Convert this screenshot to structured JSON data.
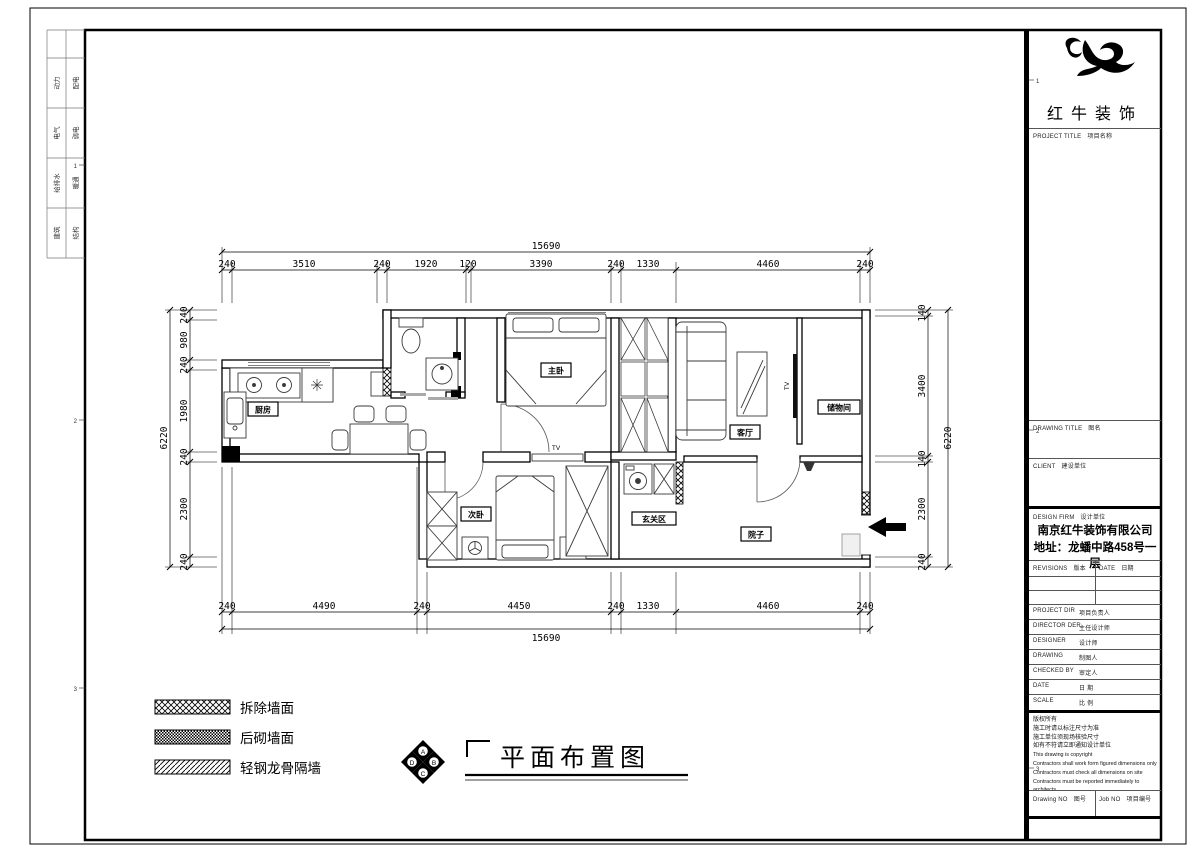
{
  "colors": {
    "ink": "#000000",
    "paper": "#ffffff"
  },
  "border": {
    "disciplines": [
      {
        "a": "动力",
        "b": "配电"
      },
      {
        "a": "电气",
        "b": "弱电"
      },
      {
        "a": "给排水",
        "b": "暖通"
      },
      {
        "a": "建筑",
        "b": "结构"
      }
    ],
    "grid_refs": [
      "1",
      "2",
      "3"
    ]
  },
  "title_block": {
    "brand": "红牛装饰",
    "project_title": {
      "en": "PROJECT TITLE",
      "cn": "项目名称"
    },
    "drawing_title": {
      "en": "DRAWING TITLE",
      "cn": "图名"
    },
    "client": {
      "en": "CLIENT",
      "cn": "建设单位"
    },
    "design_firm": {
      "en": "DESIGN FIRM",
      "cn": "设计单位"
    },
    "company": "南京红牛装饰有限公司",
    "address": "地址：龙蟠中路458号一层",
    "revisions": {
      "en": "REVISIONS",
      "cn": "版本"
    },
    "date_col": {
      "en": "DATE",
      "cn": "日期"
    },
    "rows": [
      {
        "en": "PROJECT DIR",
        "cn": "项目负责人"
      },
      {
        "en": "DIRECTOR DER",
        "cn": "主任设计师"
      },
      {
        "en": "DESIGNER",
        "cn": "设计师"
      },
      {
        "en": "DRAWING",
        "cn": "制图人"
      },
      {
        "en": "CHECKED BY",
        "cn": "审定人"
      },
      {
        "en": "DATE",
        "cn": "日 期"
      },
      {
        "en": "SCALE",
        "cn": "比 例"
      }
    ],
    "copyright": [
      "版权所有",
      "施工时请以标注尺寸为准",
      "施工单位须现场核验尺寸",
      "如有不符请立即通知设计单位",
      "This drawing is copyright",
      "Contractors shall work form figured dimensions only",
      "Contractors must check all dimensions on site",
      "Contractors must be reported immediately to architects"
    ],
    "drawing_no": {
      "en": "Drawing NO",
      "cn": "图号"
    },
    "job_no": {
      "en": "Job NO",
      "cn": "项目编号"
    }
  },
  "plan": {
    "rooms": [
      {
        "name": "厨房"
      },
      {
        "name": "主卧"
      },
      {
        "name": "客厅"
      },
      {
        "name": "储物间"
      },
      {
        "name": "次卧"
      },
      {
        "name": "玄关区"
      },
      {
        "name": "院子"
      }
    ],
    "tv_labels": [
      "TV",
      "TV"
    ],
    "dimensions": {
      "top": {
        "overall": "15690",
        "segments": [
          "240",
          "3510",
          "240",
          "1920",
          "120",
          "3390",
          "240",
          "1330",
          "4460",
          "240"
        ]
      },
      "bottom": {
        "overall": "15690",
        "segments": [
          "240",
          "4490",
          "240",
          "4450",
          "240",
          "1330",
          "4460",
          "240"
        ]
      },
      "left": {
        "overall": "6220",
        "segments": [
          "240",
          "980",
          "240",
          "1980",
          "240",
          "2300",
          "240"
        ]
      },
      "right": {
        "overall": "6220",
        "segments": [
          "140",
          "3400",
          "140",
          "2300",
          "240"
        ]
      }
    }
  },
  "legend": {
    "items": [
      {
        "label": "拆除墙面"
      },
      {
        "label": "后砌墙面"
      },
      {
        "label": "轻钢龙骨隔墙"
      }
    ]
  },
  "sheet_title": {
    "text": "平面布置图",
    "compass": [
      "A",
      "B",
      "C",
      "D"
    ]
  }
}
